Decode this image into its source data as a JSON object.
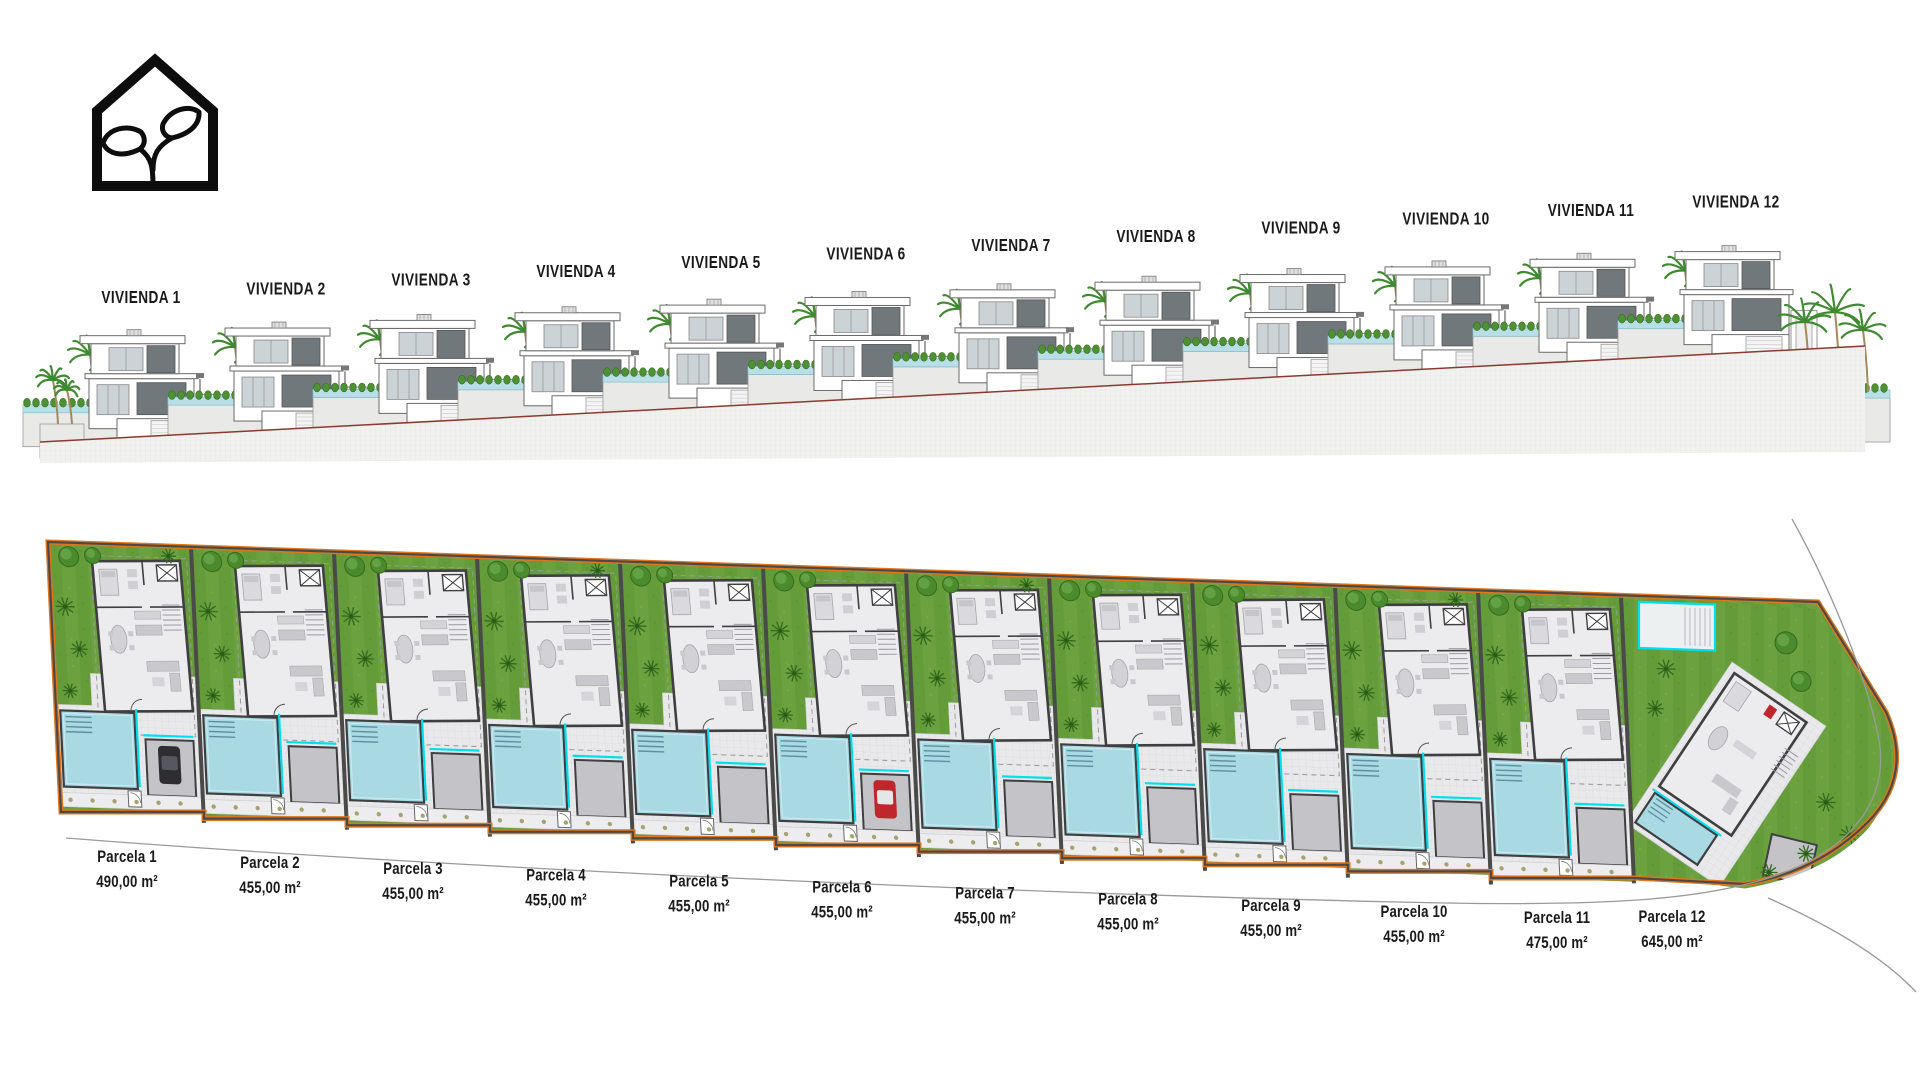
{
  "sheet": {
    "title": "residential development elevation and site plan"
  },
  "logo": {
    "name": "eco-house-logo"
  },
  "elevation": {
    "items": [
      {
        "label": "VIVIENDA 1"
      },
      {
        "label": "VIVIENDA 2"
      },
      {
        "label": "VIVIENDA 3"
      },
      {
        "label": "VIVIENDA 4"
      },
      {
        "label": "VIVIENDA 5"
      },
      {
        "label": "VIVIENDA 6"
      },
      {
        "label": "VIVIENDA 7"
      },
      {
        "label": "VIVIENDA 8"
      },
      {
        "label": "VIVIENDA 9"
      },
      {
        "label": "VIVIENDA 10"
      },
      {
        "label": "VIVIENDA 11"
      },
      {
        "label": "VIVIENDA 12"
      }
    ]
  },
  "plan": {
    "parcels": [
      {
        "label": "Parcela 1",
        "area": "490,00 m²",
        "car": "dark"
      },
      {
        "label": "Parcela 2",
        "area": "455,00 m²",
        "car": "none"
      },
      {
        "label": "Parcela 3",
        "area": "455,00 m²",
        "car": "none"
      },
      {
        "label": "Parcela 4",
        "area": "455,00 m²",
        "car": "none"
      },
      {
        "label": "Parcela 5",
        "area": "455,00 m²",
        "car": "none"
      },
      {
        "label": "Parcela 6",
        "area": "455,00 m²",
        "car": "red"
      },
      {
        "label": "Parcela 7",
        "area": "455,00 m²",
        "car": "none"
      },
      {
        "label": "Parcela 8",
        "area": "455,00 m²",
        "car": "none"
      },
      {
        "label": "Parcela 9",
        "area": "455,00 m²",
        "car": "none"
      },
      {
        "label": "Parcela 10",
        "area": "455,00 m²",
        "car": "none"
      },
      {
        "label": "Parcela 11",
        "area": "475,00 m²",
        "car": "none"
      },
      {
        "label": "Parcela 12",
        "area": "645,00 m²",
        "car": "none"
      }
    ]
  },
  "colors": {
    "lawn": "#6ba23f",
    "lawn_stripe": "#659c3a",
    "tree": "#4c8a2e",
    "tree_dark": "#356d1f",
    "pool": "#a9d9e3",
    "pool_glass": "#b8dfe8",
    "cyan_fence": "#00dff0",
    "terrace": "#e9e9eb",
    "terrace_line": "#d9d9dc",
    "wall_dark": "#3f3f41",
    "driveway": "#c4c4c8",
    "walkway": "#ededef",
    "boundary_orange": "#e0751c",
    "boundary_dark": "#4a4a48",
    "terrain": "#f1f1f0",
    "terrain_line": "#e4e4e2",
    "slope_line": "#8b3a2e",
    "car_red": "#c0272d",
    "car_dark": "#2e2e32",
    "road_line": "#9a9a9a",
    "label": "#1a1a1a",
    "window_dark": "#71787c",
    "glass": "#ccd3d6",
    "shrub": "#4d9134",
    "trunk": "#a5885c"
  }
}
